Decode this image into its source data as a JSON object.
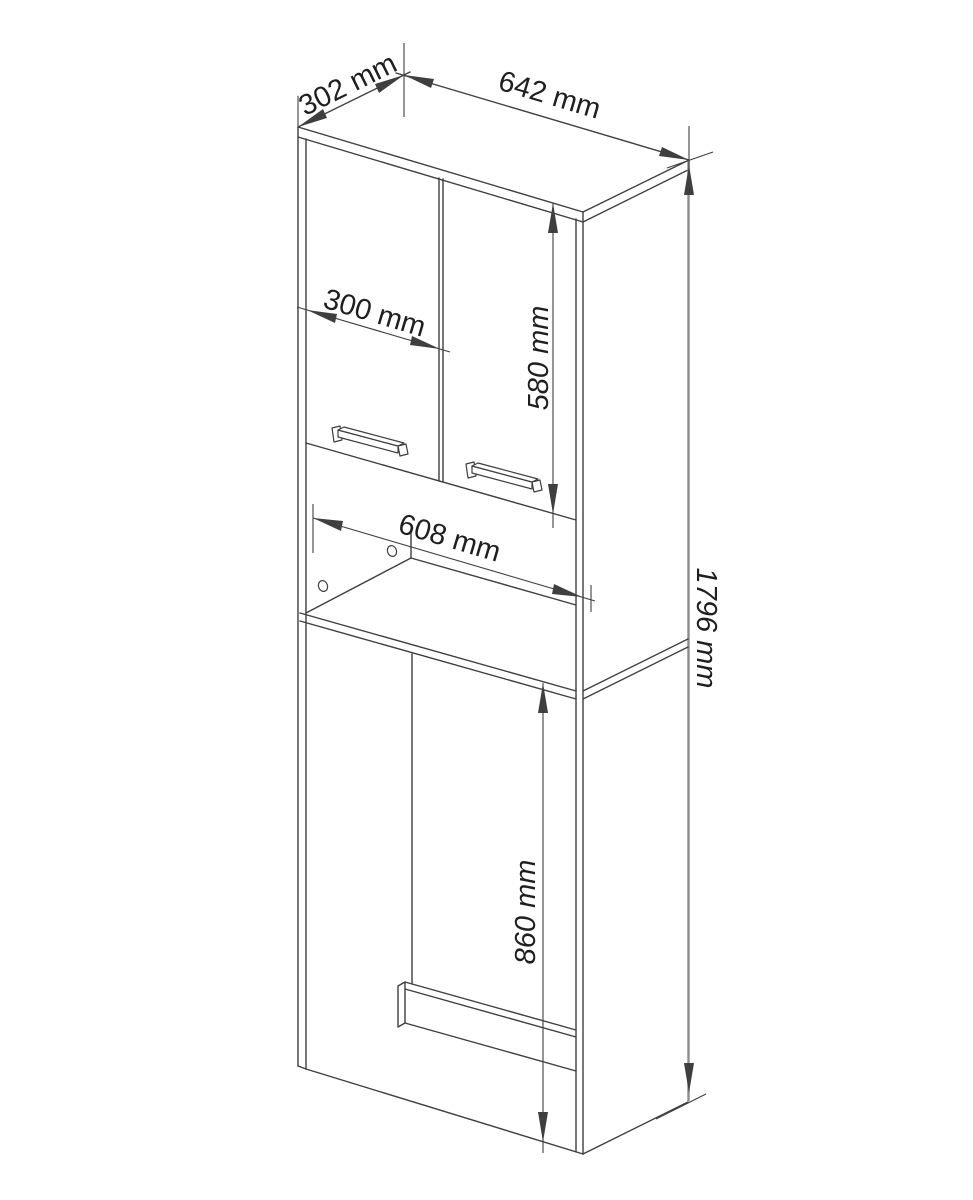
{
  "diagram": {
    "type": "furniture-technical-drawing",
    "subject": "tall bathroom cabinet over washing machine, axonometric line drawing with dimensions",
    "unit": "mm",
    "labels": {
      "depth": "302 mm",
      "width": "642 mm",
      "door_width": "300 mm",
      "door_height": "580 mm",
      "niche_width": "608 mm",
      "total_height": "1796 mm",
      "opening_height": "860 mm"
    },
    "colors": {
      "line": "#3f3f3f",
      "text": "#1f1f1f",
      "background": "#ffffff",
      "edge": "#8b8b8b"
    }
  }
}
